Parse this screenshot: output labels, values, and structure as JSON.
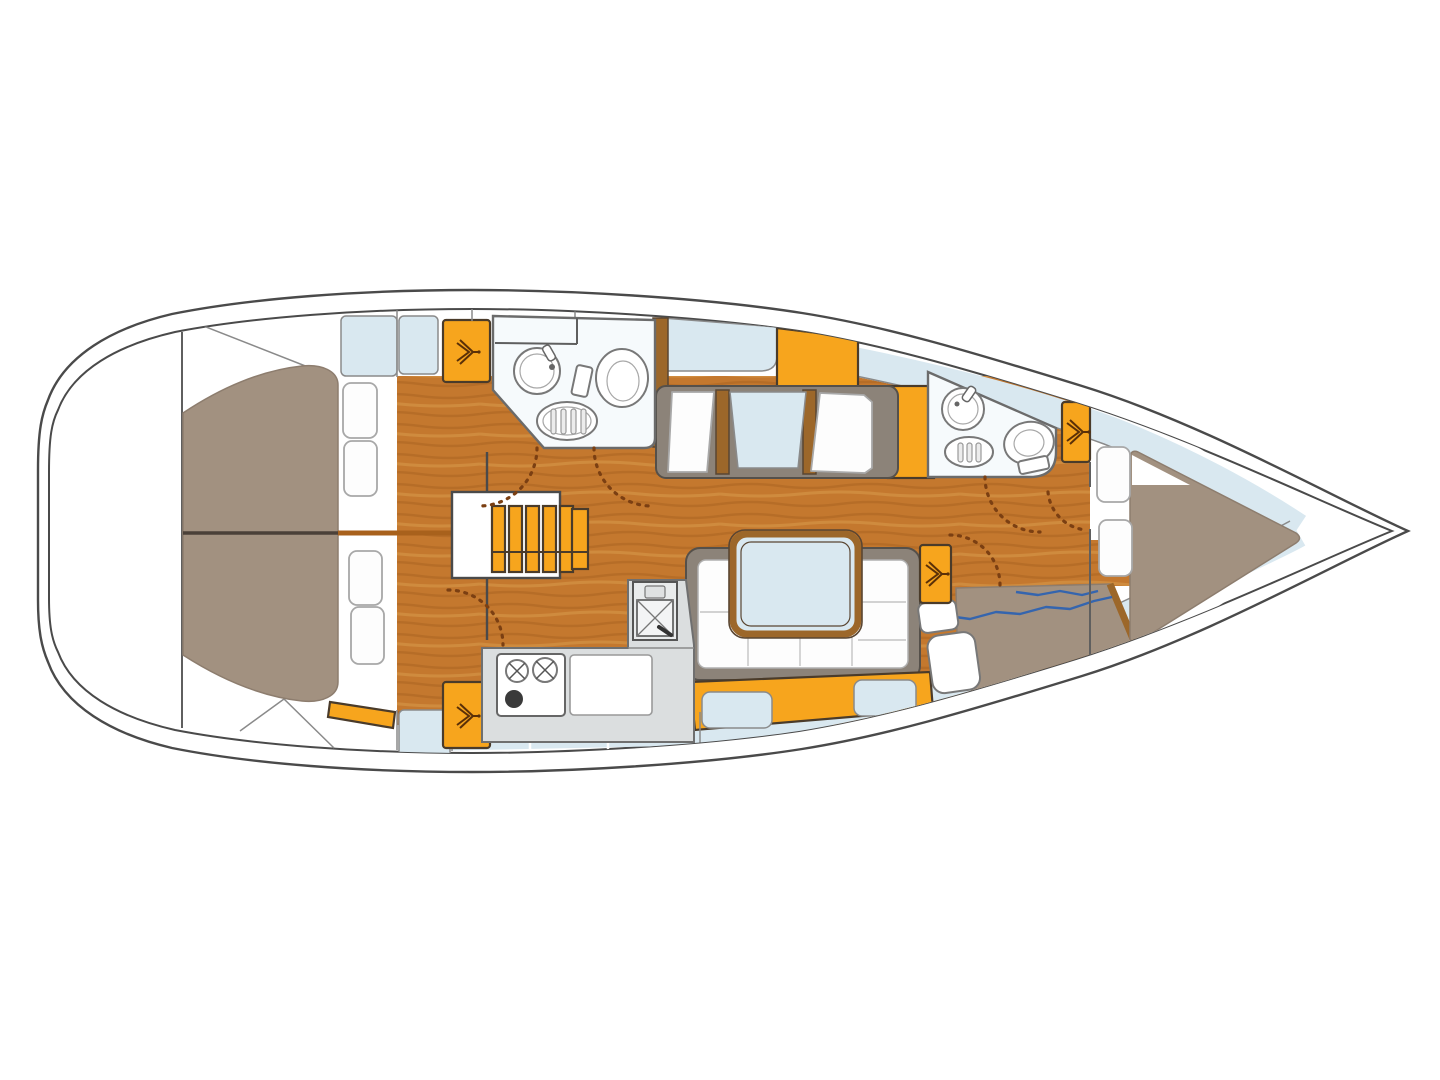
{
  "diagram": {
    "type": "yacht-interior-floor-plan",
    "orientation": "bow-right",
    "areas": [
      {
        "id": "stern-lazarette",
        "features": [
          "storage-panels"
        ]
      },
      {
        "id": "aft-cabin",
        "features": [
          "double-berth",
          "berth-centerline",
          "pillows",
          "side-shelves",
          "hanging-locker"
        ]
      },
      {
        "id": "aft-head",
        "features": [
          "washbasin",
          "toilet",
          "shower-grate"
        ]
      },
      {
        "id": "companionway",
        "features": [
          "steps",
          "mast-line"
        ]
      },
      {
        "id": "saloon",
        "features": [
          "port-settee",
          "settee-table",
          "dinette-table",
          "u-shaped-settee",
          "side-shelves"
        ]
      },
      {
        "id": "galley",
        "features": [
          "two-burner-stove",
          "worktop",
          "sink"
        ]
      },
      {
        "id": "forward-head",
        "features": [
          "washbasin",
          "toilet",
          "shower-grate"
        ]
      },
      {
        "id": "nav-station",
        "features": [
          "chart-table",
          "nav-seat",
          "hanging-locker"
        ]
      },
      {
        "id": "forward-cabin",
        "features": [
          "v-berth",
          "pillows",
          "hanging-locker",
          "side-decks"
        ]
      }
    ]
  },
  "palette": {
    "background": "#ffffff",
    "hull_line": "#4a4a4a",
    "wood_floor": "#c4782e",
    "wood_grain_dark": "#a55f1e",
    "wood_grain_light": "#d89a4a",
    "wood_trim": "#9c672a",
    "accent_orange": "#f7a51d",
    "accent_border": "#4a3b2a",
    "upholstery_taupe": "#a29180",
    "cushion_blue": "#d9e8f0",
    "frame_gray": "#8c8379",
    "counter_gray": "#dbdedf",
    "room_floor": "#f6fafc",
    "door_arc": "#7b3f12",
    "chart_line": "#3565ae",
    "outline_gray": "#8a8a8a"
  }
}
